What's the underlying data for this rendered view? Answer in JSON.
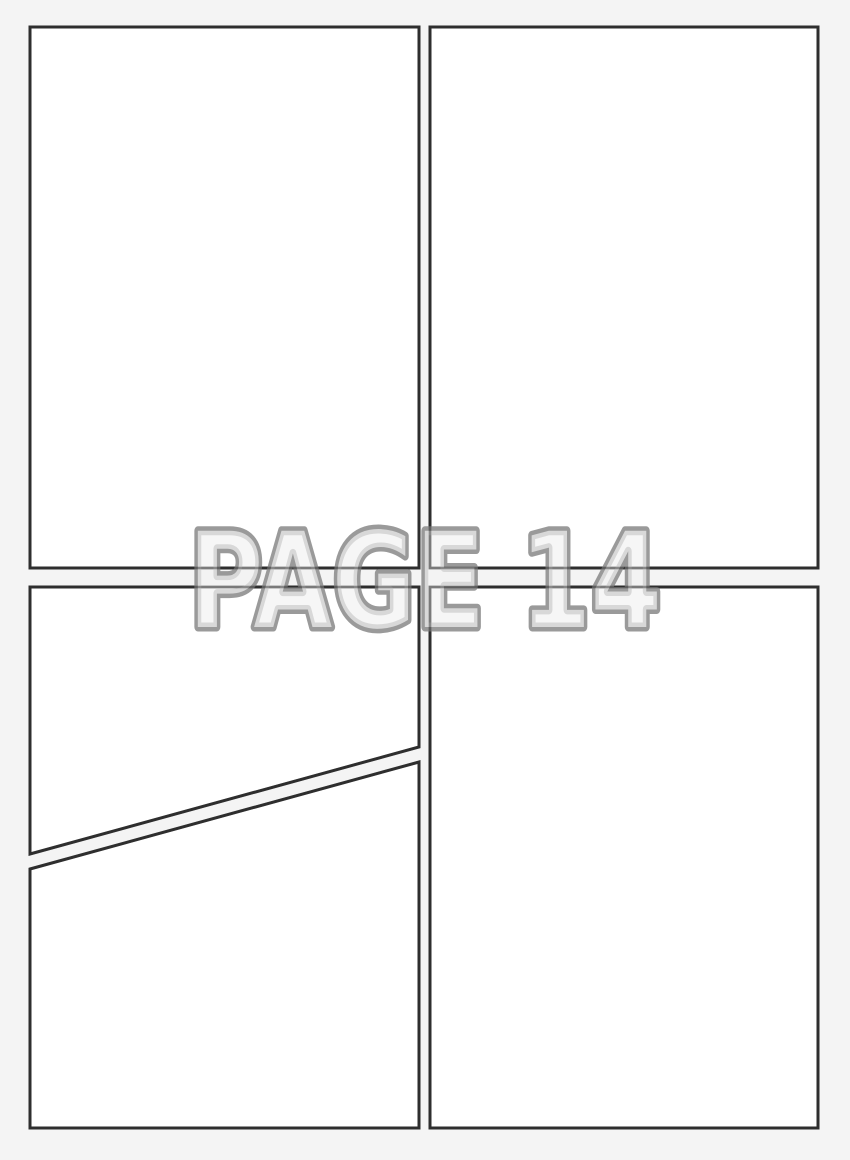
{
  "watermark": {
    "text": "PAGE 14"
  },
  "colors": {
    "page_bg": "#f4f4f4",
    "panel_fill": "#ffffff",
    "panel_border": "#2f2f2f",
    "watermark_fill": "#f2f2f2",
    "watermark_stroke": "#8f8f8f"
  }
}
